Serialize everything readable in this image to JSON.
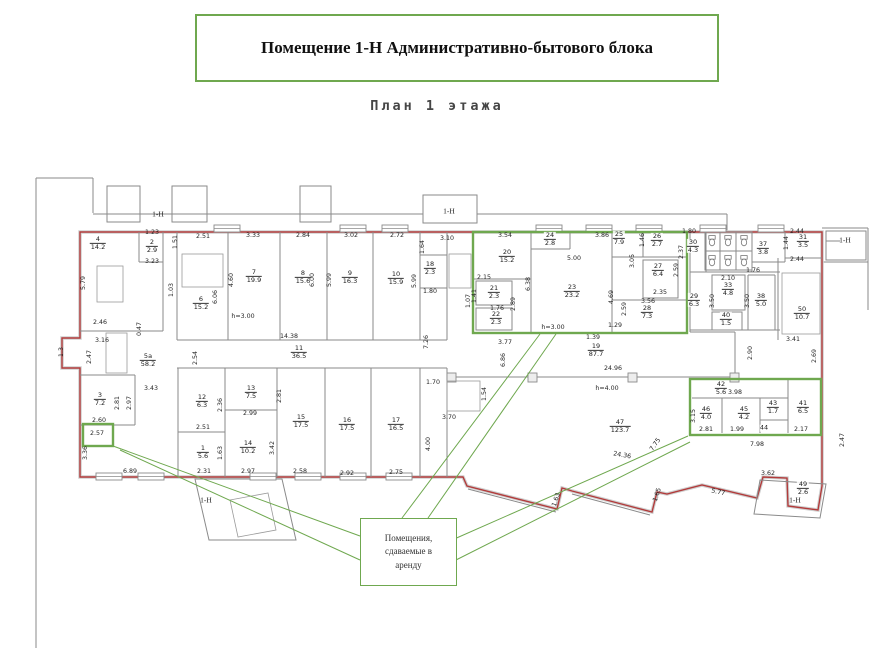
{
  "title": {
    "text": "Помещение 1-Н Административно-бытового блока"
  },
  "subtitle": {
    "text": "План 1 этажа"
  },
  "callout": {
    "text": "Помещения,\nсдаваемые в\nаренду"
  },
  "colors": {
    "highlight_green": "#6fa84f",
    "perimeter_red": "#b23b3b",
    "wall_gray": "#8a8a8a"
  },
  "plan": {
    "marks": [
      {
        "t": "1-Н",
        "x": 158,
        "y": 214
      },
      {
        "t": "1-Н",
        "x": 449,
        "y": 211
      },
      {
        "t": "1-Н",
        "x": 845,
        "y": 240
      },
      {
        "t": "1-Н",
        "x": 206,
        "y": 500
      },
      {
        "t": "1-Н",
        "x": 795,
        "y": 500
      }
    ],
    "rooms": [
      {
        "n": "4",
        "a": "14.2",
        "x": 98,
        "y": 243
      },
      {
        "n": "2",
        "a": "2.9",
        "x": 152,
        "y": 246
      },
      {
        "n": "6",
        "a": "15.2",
        "x": 201,
        "y": 303
      },
      {
        "n": "7",
        "a": "19.9",
        "x": 254,
        "y": 276
      },
      {
        "n": "8",
        "a": "15.6",
        "x": 303,
        "y": 277
      },
      {
        "n": "9",
        "a": "16.3",
        "x": 350,
        "y": 277
      },
      {
        "n": "10",
        "a": "15.9",
        "x": 396,
        "y": 278
      },
      {
        "n": "18",
        "a": "2.3",
        "x": 430,
        "y": 268
      },
      {
        "n": "20",
        "a": "15.2",
        "x": 507,
        "y": 256
      },
      {
        "n": "21",
        "a": "2.3",
        "x": 494,
        "y": 292
      },
      {
        "n": "22",
        "a": "2.3",
        "x": 496,
        "y": 318
      },
      {
        "n": "23",
        "a": "23.2",
        "x": 572,
        "y": 291
      },
      {
        "n": "24",
        "a": "2.8",
        "x": 550,
        "y": 239
      },
      {
        "n": "25",
        "a": "7.9",
        "x": 619,
        "y": 238
      },
      {
        "n": "26",
        "a": "2.7",
        "x": 657,
        "y": 240
      },
      {
        "n": "27",
        "a": "6.4",
        "x": 658,
        "y": 270
      },
      {
        "n": "28",
        "a": "7.3",
        "x": 647,
        "y": 312
      },
      {
        "n": "30",
        "a": "4.3",
        "x": 693,
        "y": 246
      },
      {
        "n": "37",
        "a": "3.8",
        "x": 763,
        "y": 248
      },
      {
        "n": "31",
        "a": "3.5",
        "x": 803,
        "y": 241
      },
      {
        "n": "29",
        "a": "6.3",
        "x": 694,
        "y": 300
      },
      {
        "n": "33",
        "a": "4.8",
        "x": 728,
        "y": 289
      },
      {
        "n": "38",
        "a": "5.0",
        "x": 761,
        "y": 300
      },
      {
        "n": "40",
        "a": "1.5",
        "x": 726,
        "y": 319
      },
      {
        "n": "50",
        "a": "10.7",
        "x": 802,
        "y": 313
      },
      {
        "n": "3",
        "a": "7.2",
        "x": 100,
        "y": 399
      },
      {
        "n": "5а",
        "a": "58.2",
        "x": 148,
        "y": 360
      },
      {
        "n": "11",
        "a": "36.5",
        "x": 299,
        "y": 352
      },
      {
        "n": "12",
        "a": "6.3",
        "x": 202,
        "y": 401
      },
      {
        "n": "13",
        "a": "7.5",
        "x": 251,
        "y": 392
      },
      {
        "n": "14",
        "a": "10.2",
        "x": 248,
        "y": 447
      },
      {
        "n": "1",
        "a": "5.6",
        "x": 203,
        "y": 452
      },
      {
        "n": "15",
        "a": "17.5",
        "x": 301,
        "y": 421
      },
      {
        "n": "16",
        "a": "17.5",
        "x": 347,
        "y": 424
      },
      {
        "n": "17",
        "a": "16.5",
        "x": 396,
        "y": 424
      },
      {
        "n": "19",
        "a": "87.7",
        "x": 596,
        "y": 350
      },
      {
        "n": "47",
        "a": "123.7",
        "x": 620,
        "y": 426
      },
      {
        "n": "42",
        "a": "5.6",
        "x": 721,
        "y": 388
      },
      {
        "n": "46",
        "a": "4.0",
        "x": 706,
        "y": 413
      },
      {
        "n": "45",
        "a": "4.2",
        "x": 744,
        "y": 413
      },
      {
        "n": "43",
        "a": "1.7",
        "x": 773,
        "y": 407
      },
      {
        "n": "44",
        "a": "",
        "x": 764,
        "y": 428
      },
      {
        "n": "41",
        "a": "6.5",
        "x": 803,
        "y": 407
      },
      {
        "n": "49",
        "a": "2.6",
        "x": 803,
        "y": 488
      }
    ],
    "dims": [
      {
        "t": "1.23",
        "x": 152,
        "y": 233
      },
      {
        "t": "3.23",
        "x": 152,
        "y": 262
      },
      {
        "t": "1.51",
        "x": 176,
        "y": 242,
        "r": -90
      },
      {
        "t": "2.51",
        "x": 203,
        "y": 237
      },
      {
        "t": "3.33",
        "x": 253,
        "y": 236
      },
      {
        "t": "2.84",
        "x": 303,
        "y": 236
      },
      {
        "t": "3.02",
        "x": 351,
        "y": 236
      },
      {
        "t": "2.72",
        "x": 397,
        "y": 236
      },
      {
        "t": "3.10",
        "x": 447,
        "y": 239
      },
      {
        "t": "1.64",
        "x": 423,
        "y": 247,
        "r": -90
      },
      {
        "t": "3.54",
        "x": 505,
        "y": 236
      },
      {
        "t": "3.86",
        "x": 602,
        "y": 236
      },
      {
        "t": "1.46",
        "x": 643,
        "y": 240,
        "r": -90
      },
      {
        "t": "1.80",
        "x": 689,
        "y": 232
      },
      {
        "t": "2.44",
        "x": 797,
        "y": 232
      },
      {
        "t": "1.44",
        "x": 787,
        "y": 243,
        "r": -90
      },
      {
        "t": "2.44",
        "x": 797,
        "y": 260
      },
      {
        "t": "2.37",
        "x": 682,
        "y": 252,
        "r": -90
      },
      {
        "t": "3.05",
        "x": 633,
        "y": 261,
        "r": -90
      },
      {
        "t": "2.59",
        "x": 677,
        "y": 270,
        "r": -90
      },
      {
        "t": "2.35",
        "x": 660,
        "y": 293
      },
      {
        "t": "3.56",
        "x": 648,
        "y": 302
      },
      {
        "t": "2.59",
        "x": 625,
        "y": 309,
        "r": -90
      },
      {
        "t": "5.00",
        "x": 574,
        "y": 259
      },
      {
        "t": "4.69",
        "x": 612,
        "y": 297,
        "r": -90
      },
      {
        "t": "6.38",
        "x": 529,
        "y": 284,
        "r": -90
      },
      {
        "t": "2.15",
        "x": 484,
        "y": 278
      },
      {
        "t": "1.41",
        "x": 475,
        "y": 296,
        "r": -90
      },
      {
        "t": "1.76",
        "x": 497,
        "y": 309
      },
      {
        "t": "2.89",
        "x": 514,
        "y": 304,
        "r": -90
      },
      {
        "t": "1.07",
        "x": 469,
        "y": 301,
        "r": -90
      },
      {
        "t": "3.77",
        "x": 505,
        "y": 343
      },
      {
        "t": "6.86",
        "x": 504,
        "y": 360,
        "r": -90
      },
      {
        "t": "h=3.00",
        "x": 553,
        "y": 328
      },
      {
        "t": "1.80",
        "x": 430,
        "y": 292
      },
      {
        "t": "7.26",
        "x": 427,
        "y": 342,
        "r": -90
      },
      {
        "t": "5.99",
        "x": 330,
        "y": 280,
        "r": -90
      },
      {
        "t": "5.99",
        "x": 415,
        "y": 281,
        "r": -90
      },
      {
        "t": "4.60",
        "x": 232,
        "y": 280,
        "r": -90
      },
      {
        "t": "6.00",
        "x": 313,
        "y": 280,
        "r": -90
      },
      {
        "t": "6.06",
        "x": 216,
        "y": 297,
        "r": -90
      },
      {
        "t": "1.03",
        "x": 172,
        "y": 290,
        "r": -90
      },
      {
        "t": "0.47",
        "x": 140,
        "y": 329,
        "r": -90
      },
      {
        "t": "h=3.00",
        "x": 243,
        "y": 317
      },
      {
        "t": "2.46",
        "x": 100,
        "y": 323
      },
      {
        "t": "5.79",
        "x": 84,
        "y": 283,
        "r": -90
      },
      {
        "t": "3.16",
        "x": 102,
        "y": 341
      },
      {
        "t": "2.47",
        "x": 90,
        "y": 357,
        "r": -90
      },
      {
        "t": "1.3",
        "x": 62,
        "y": 352,
        "r": -90
      },
      {
        "t": "2.54",
        "x": 196,
        "y": 358,
        "r": -90
      },
      {
        "t": "3.43",
        "x": 151,
        "y": 389
      },
      {
        "t": "2.81",
        "x": 118,
        "y": 403,
        "r": -90
      },
      {
        "t": "2.97",
        "x": 130,
        "y": 403,
        "r": -90
      },
      {
        "t": "2.60",
        "x": 99,
        "y": 421
      },
      {
        "t": "2.57",
        "x": 97,
        "y": 434
      },
      {
        "t": "3.36",
        "x": 86,
        "y": 453,
        "r": -90
      },
      {
        "t": "6.89",
        "x": 130,
        "y": 472
      },
      {
        "t": "2.31",
        "x": 204,
        "y": 472
      },
      {
        "t": "2.97",
        "x": 248,
        "y": 472
      },
      {
        "t": "2.58",
        "x": 300,
        "y": 472
      },
      {
        "t": "2.92",
        "x": 347,
        "y": 474
      },
      {
        "t": "2.75",
        "x": 396,
        "y": 473
      },
      {
        "t": "14.38",
        "x": 289,
        "y": 337
      },
      {
        "t": "2.36",
        "x": 221,
        "y": 405,
        "r": -90
      },
      {
        "t": "2.99",
        "x": 250,
        "y": 414
      },
      {
        "t": "2.81",
        "x": 280,
        "y": 396,
        "r": -90
      },
      {
        "t": "3.42",
        "x": 273,
        "y": 448,
        "r": -90
      },
      {
        "t": "1.63",
        "x": 221,
        "y": 453,
        "r": -90
      },
      {
        "t": "2.51",
        "x": 203,
        "y": 428
      },
      {
        "t": "1.70",
        "x": 433,
        "y": 383
      },
      {
        "t": "3.70",
        "x": 449,
        "y": 418
      },
      {
        "t": "1.54",
        "x": 485,
        "y": 394,
        "r": -90
      },
      {
        "t": "4.00",
        "x": 429,
        "y": 444,
        "r": -90
      },
      {
        "t": "1.39",
        "x": 593,
        "y": 338
      },
      {
        "t": "24.96",
        "x": 613,
        "y": 369
      },
      {
        "t": "h=4.00",
        "x": 607,
        "y": 389
      },
      {
        "t": "24.36",
        "x": 622,
        "y": 456,
        "r": 10
      },
      {
        "t": "7.75",
        "x": 656,
        "y": 445,
        "r": -55
      },
      {
        "t": "2.90",
        "x": 751,
        "y": 353,
        "r": -90
      },
      {
        "t": "3.41",
        "x": 793,
        "y": 340
      },
      {
        "t": "2.69",
        "x": 815,
        "y": 356,
        "r": -90
      },
      {
        "t": "3.15",
        "x": 694,
        "y": 416,
        "r": -90
      },
      {
        "t": "3.98",
        "x": 735,
        "y": 393
      },
      {
        "t": "2.81",
        "x": 706,
        "y": 430
      },
      {
        "t": "1.99",
        "x": 737,
        "y": 430
      },
      {
        "t": "2.17",
        "x": 801,
        "y": 430
      },
      {
        "t": "7.98",
        "x": 757,
        "y": 445
      },
      {
        "t": "5.77",
        "x": 718,
        "y": 493,
        "r": 12
      },
      {
        "t": "1.63",
        "x": 557,
        "y": 500,
        "r": -72
      },
      {
        "t": "1.65",
        "x": 658,
        "y": 495,
        "r": -72
      },
      {
        "t": "3.62",
        "x": 768,
        "y": 474
      },
      {
        "t": "2.47",
        "x": 843,
        "y": 440,
        "r": -90
      },
      {
        "t": "1.29",
        "x": 615,
        "y": 326
      },
      {
        "t": "2.10",
        "x": 728,
        "y": 279
      },
      {
        "t": "1.76",
        "x": 753,
        "y": 271
      },
      {
        "t": "3.50",
        "x": 713,
        "y": 301,
        "r": -90
      },
      {
        "t": "3.50",
        "x": 748,
        "y": 301,
        "r": -90
      }
    ]
  }
}
